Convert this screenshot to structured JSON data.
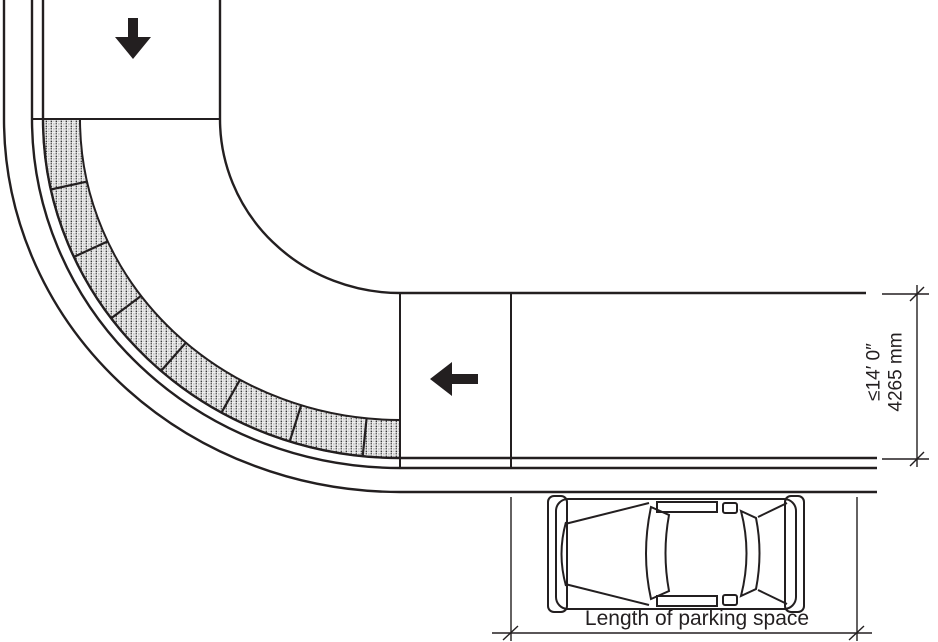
{
  "labels": {
    "parking_space_length": "Length of parking space",
    "roadway_width_imperial": "≤14′ 0″",
    "roadway_width_metric": "4265 mm"
  },
  "arrows": {
    "vertical_street_direction": "down",
    "horizontal_street_direction": "left"
  },
  "colors": {
    "line": "#231f20",
    "band_fill": "#f1f1f1",
    "band_dot_dark": "#3a3a3a",
    "band_dot_light": "#c2c2c2",
    "background": "#ffffff"
  }
}
